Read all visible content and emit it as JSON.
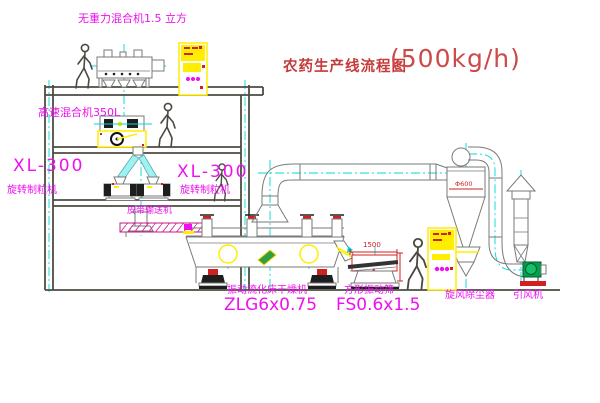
{
  "title": {
    "name": "农药生产线流程图",
    "capacity": "(500kg/h)"
  },
  "equipment_labels": {
    "gravity_mixer": "无重力混合机1.5 立方",
    "high_speed_mixer": "高速混合机350L",
    "granulator_left": {
      "model": "XL-300",
      "name": "旋转制粒机"
    },
    "granulator_right": {
      "model": "XL-300",
      "name": "旋转制粒机"
    },
    "belt_conveyor": "皮带输送机",
    "dryer": {
      "name": "振动流化床干燥机",
      "model": "ZLG6x0.75"
    },
    "screen": {
      "name": "方形振动筛",
      "model": "FS0.6x1.5"
    },
    "cyclone": "旋风除尘器",
    "induced_draft_fan": "引风机"
  },
  "dimensions": {
    "screen_length": "1500",
    "cyclone_diameter": "Φ600"
  },
  "colors": {
    "label_magenta": "#ee10ee",
    "title_red": "#c43b3b",
    "dimension_red": "#d02020",
    "centerline_cyan": "#00d8d8",
    "cabinet_yellow": "#ffee00",
    "structure_dark": "#4c4c42",
    "equipment_gray": "#7a7a7a",
    "fan_green": "#00a050"
  }
}
